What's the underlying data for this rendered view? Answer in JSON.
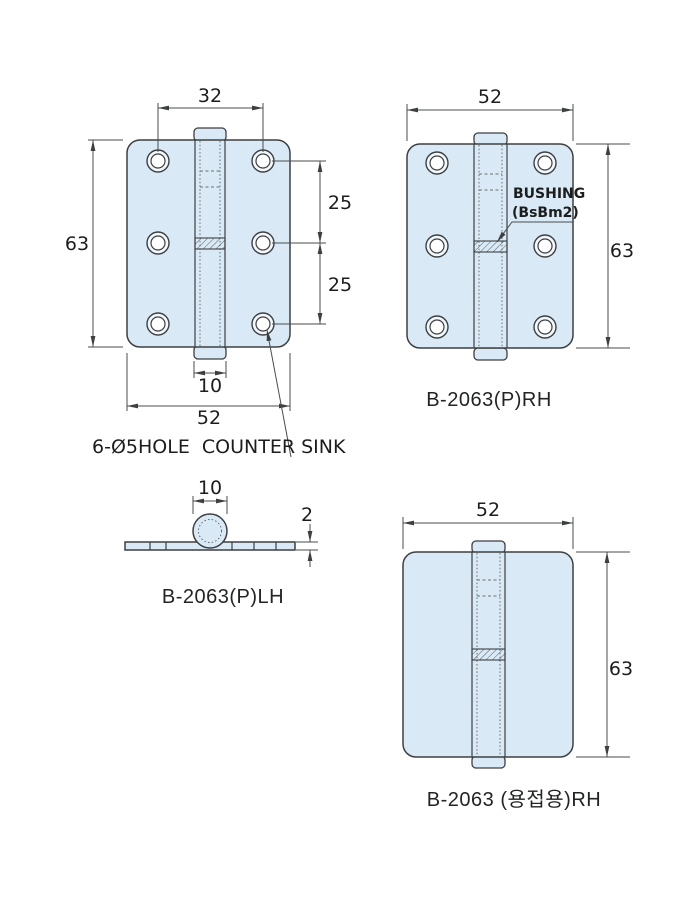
{
  "colors": {
    "background": "#ffffff",
    "plate-fill": "#d9eaf6",
    "outline": "#3d3f41",
    "dim-line": "#4a4c4e",
    "text": "#1d1d1d"
  },
  "views": {
    "front_lh": {
      "dim_hole_span": "32",
      "dim_height": "63",
      "dim_pitch_upper": "25",
      "dim_pitch_lower": "25",
      "dim_knuckle": "10",
      "dim_width": "52",
      "note": "6-Ø5HOLE  COUNTER SINK"
    },
    "front_rh": {
      "dim_width": "52",
      "dim_height": "63",
      "bushing_title": "BUSHING",
      "bushing_spec": "(BsBm2)",
      "part_label": "B-2063(P)RH"
    },
    "side_lh": {
      "dim_knuckle": "10",
      "dim_thickness": "2",
      "part_label": "B-2063(P)LH"
    },
    "front_weld_rh": {
      "dim_width": "52",
      "dim_height": "63",
      "part_label": "B-2063 (용접용)RH"
    }
  }
}
